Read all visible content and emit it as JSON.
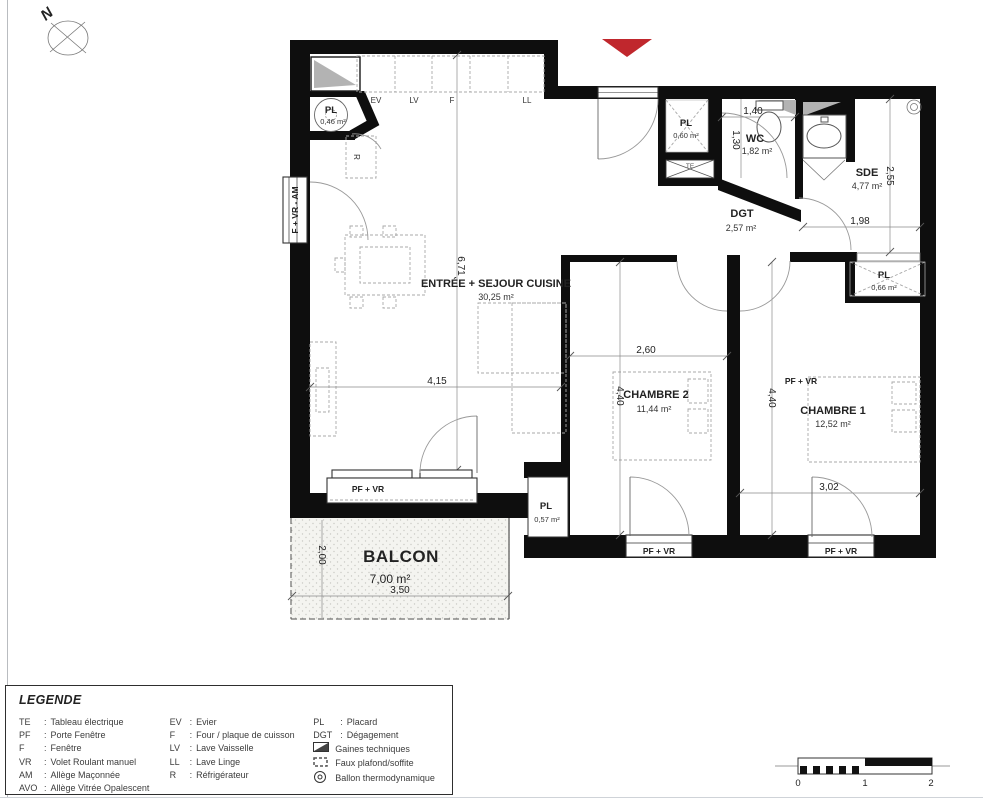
{
  "compass": {
    "north": "N"
  },
  "colors": {
    "entrance_marker": "#c0272d",
    "gaines_gray": "#b3b3b3",
    "balcony_fill": "#f4f4f0",
    "wall": "#0e0e0e"
  },
  "rooms": {
    "sejour": {
      "name": "ENTRÉE + SEJOUR CUISINE",
      "area": "30,25 m²",
      "dim_w": "4,15",
      "dim_h": "6,71"
    },
    "chambre2": {
      "name": "CHAMBRE 2",
      "area": "11,44 m²",
      "dim_w": "2,60",
      "dim_h": "4,40"
    },
    "chambre1": {
      "name": "CHAMBRE 1",
      "area": "12,52 m²",
      "dim_w": "3,02",
      "dim_h": "4,40",
      "window_note": "PF + VR"
    },
    "wc": {
      "name": "WC",
      "area": "1,82 m²",
      "dim_w": "1,40",
      "dim_h": "1,30"
    },
    "sde": {
      "name": "SDE",
      "area": "4,77 m²",
      "dim_w": "1,98",
      "dim_h": "2,55"
    },
    "dgt": {
      "name": "DGT",
      "area": "2,57 m²"
    },
    "balcon": {
      "name": "BALCON",
      "area": "7,00 m²",
      "dim_w": "3,50",
      "dim_h": "2,00"
    }
  },
  "closets": {
    "pl_hall": {
      "name": "PL",
      "area": "0,46 m²"
    },
    "pl_corridor": {
      "name": "PL",
      "area": "0,60 m²"
    },
    "pl_chambre1": {
      "name": "PL",
      "area": "0,66 m²"
    },
    "pl_sejour": {
      "name": "PL",
      "area": "0,57 m²"
    }
  },
  "kitchen": {
    "ev": "EV",
    "lv": "LV",
    "four": "F",
    "ll": "LL",
    "fridge": "R",
    "te": "TE"
  },
  "windows": {
    "left": "F + VR - AM",
    "sejour": "PF + VR",
    "ch2": "PF + VR",
    "ch1": "PF + VR"
  },
  "scalebar": {
    "t0": "0",
    "t1": "1",
    "t2": "2"
  },
  "legend": {
    "title": "LEGENDE",
    "sep": ":",
    "col1": [
      {
        "abbr": "TE",
        "label": "Tableau électrique"
      },
      {
        "abbr": "PF",
        "label": "Porte Fenêtre"
      },
      {
        "abbr": "F",
        "label": "Fenêtre"
      },
      {
        "abbr": "VR",
        "label": "Volet Roulant manuel"
      },
      {
        "abbr": "AM",
        "label": "Allège Maçonnée"
      },
      {
        "abbr": "AVO",
        "label": "Allège Vitrée Opalescent"
      }
    ],
    "col2": [
      {
        "abbr": "EV",
        "label": "Evier"
      },
      {
        "abbr": "F",
        "label": "Four / plaque de cuisson"
      },
      {
        "abbr": "LV",
        "label": "Lave Vaisselle"
      },
      {
        "abbr": "LL",
        "label": "Lave Linge"
      },
      {
        "abbr": "R",
        "label": "Réfrigérateur"
      }
    ],
    "col3": [
      {
        "abbr": "PL",
        "label": "Placard"
      },
      {
        "abbr": "DGT",
        "label": "Dégagement"
      }
    ],
    "symbols": [
      {
        "label": "Gaines techniques"
      },
      {
        "label": "Faux plafond/soffite"
      },
      {
        "label": "Ballon thermodynamique"
      }
    ]
  }
}
